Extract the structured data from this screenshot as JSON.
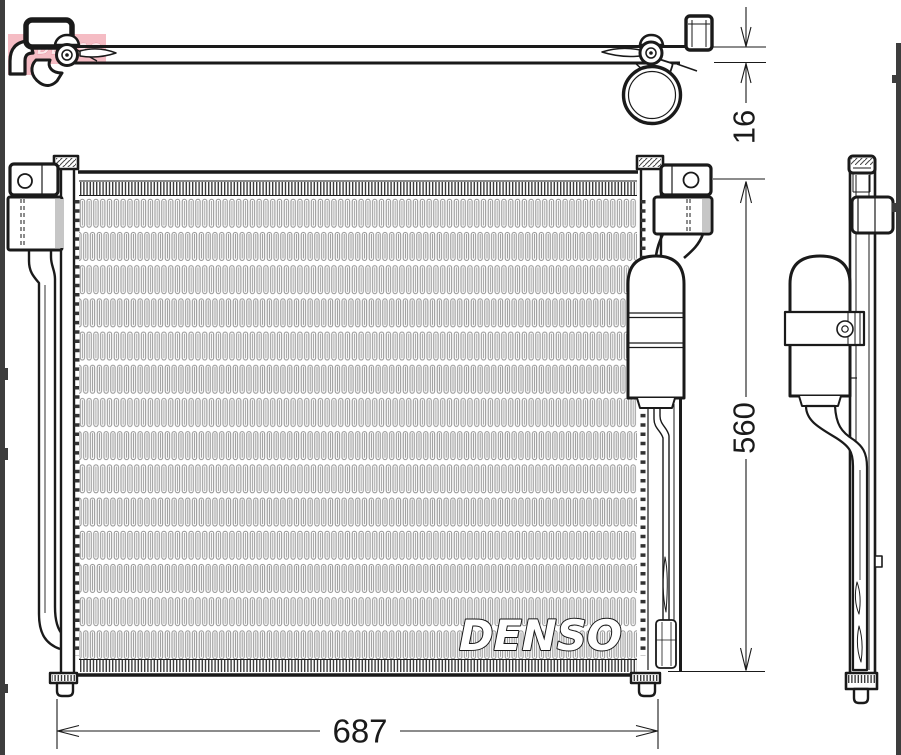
{
  "image": {
    "type": "technical-line-drawing-condenser",
    "brand_logo": "DENSO",
    "watermark": "DENSO",
    "dimensions": {
      "width": "687",
      "height": "560",
      "depth": "16"
    },
    "colors": {
      "line": "#1a1a1a",
      "fins": "#8f8f8f",
      "highlight": "#f5bcc4",
      "edge_strips": "#3d3d3d",
      "background": "#ffffff"
    }
  }
}
